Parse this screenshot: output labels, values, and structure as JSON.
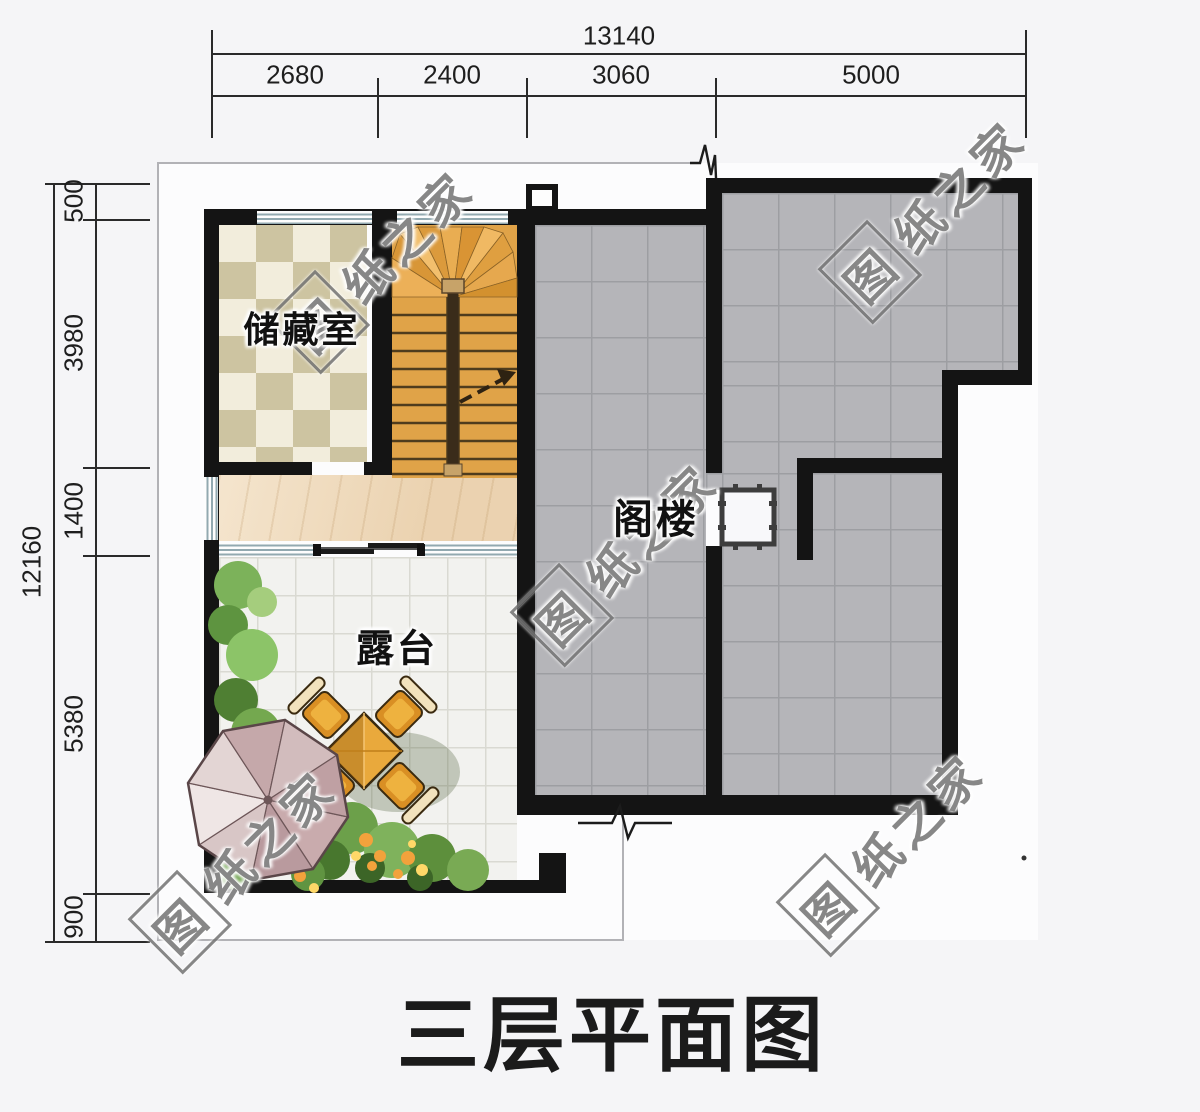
{
  "title": "三层平面图",
  "watermark": {
    "logo_char": "图",
    "rest": "纸之家"
  },
  "rooms": {
    "storage": "储藏室",
    "attic": "阁楼",
    "terrace": "露台"
  },
  "dimensions": {
    "top": {
      "total": "13140",
      "segments": [
        "2680",
        "2400",
        "3060",
        "5000"
      ]
    },
    "left": {
      "total": "12160",
      "segments": [
        "500",
        "3980",
        "1400",
        "5380",
        "900"
      ]
    }
  },
  "colors": {
    "wall": "#141414",
    "attic_tile": "#b5b5b9",
    "terrace_tile": "#f2f2ef",
    "checker_dark": "#cdc4a1",
    "checker_light": "#f2eddc",
    "wood_floor": "#f1dcbd",
    "stair_wood": "#e0a348",
    "umbrella": "#c9abad",
    "watermark_gray": "#767676"
  }
}
